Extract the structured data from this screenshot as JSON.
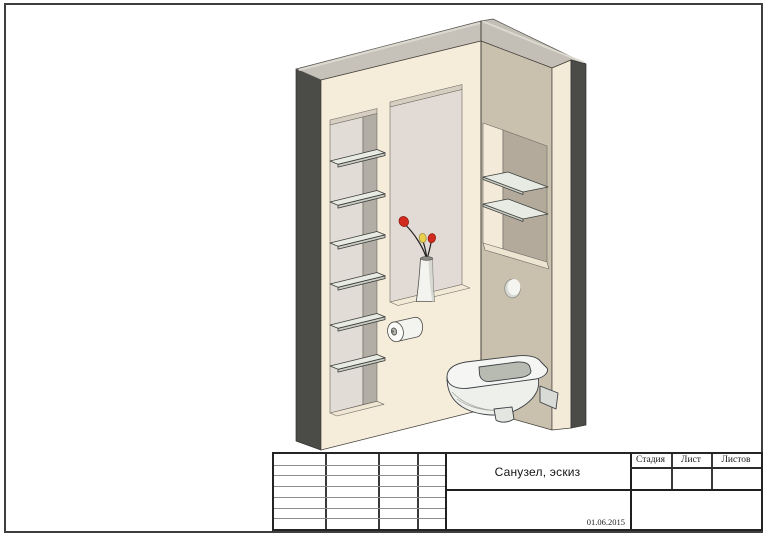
{
  "sheet": {
    "title": "Санузел, эскиз",
    "date": "01.06.2015",
    "stamp_headers": {
      "stage": "Стадия",
      "sheet": "Лист",
      "sheets": "Листов"
    }
  },
  "scene": {
    "description": "Axonometric sketch of a bathroom corner: two walls with recessed niches, six glass shelves in the left niche, two glass shelves in the right niche, a recessed panel with a vase of flowers on its sill, a toilet paper roll, a round flush button and a wall-hung toilet",
    "objects": [
      "left-wall",
      "right-wall",
      "left-niche-shelves",
      "right-niche-shelves",
      "recessed-panel",
      "vase-with-flowers",
      "toilet-paper-roll",
      "flush-button",
      "wall-hung-toilet"
    ],
    "left_niche_shelf_count": 6,
    "right_niche_shelf_count": 2,
    "colors": {
      "wall_cream": "#f6ecda",
      "wall_tan": "#cac0ae",
      "wall_edge_dark": "#4b4b48",
      "top_surface_gray": "#c6c2b9",
      "niche_back": "#e2dcd7",
      "niche_back_dark": "#b3aa9c",
      "glass_shelf": "#e7ebe3",
      "fixture_white": "#f4f5f2",
      "flower_red": "#d22a1e",
      "flower_yellow": "#e9d14e",
      "line_dark": "#3d4044"
    }
  }
}
